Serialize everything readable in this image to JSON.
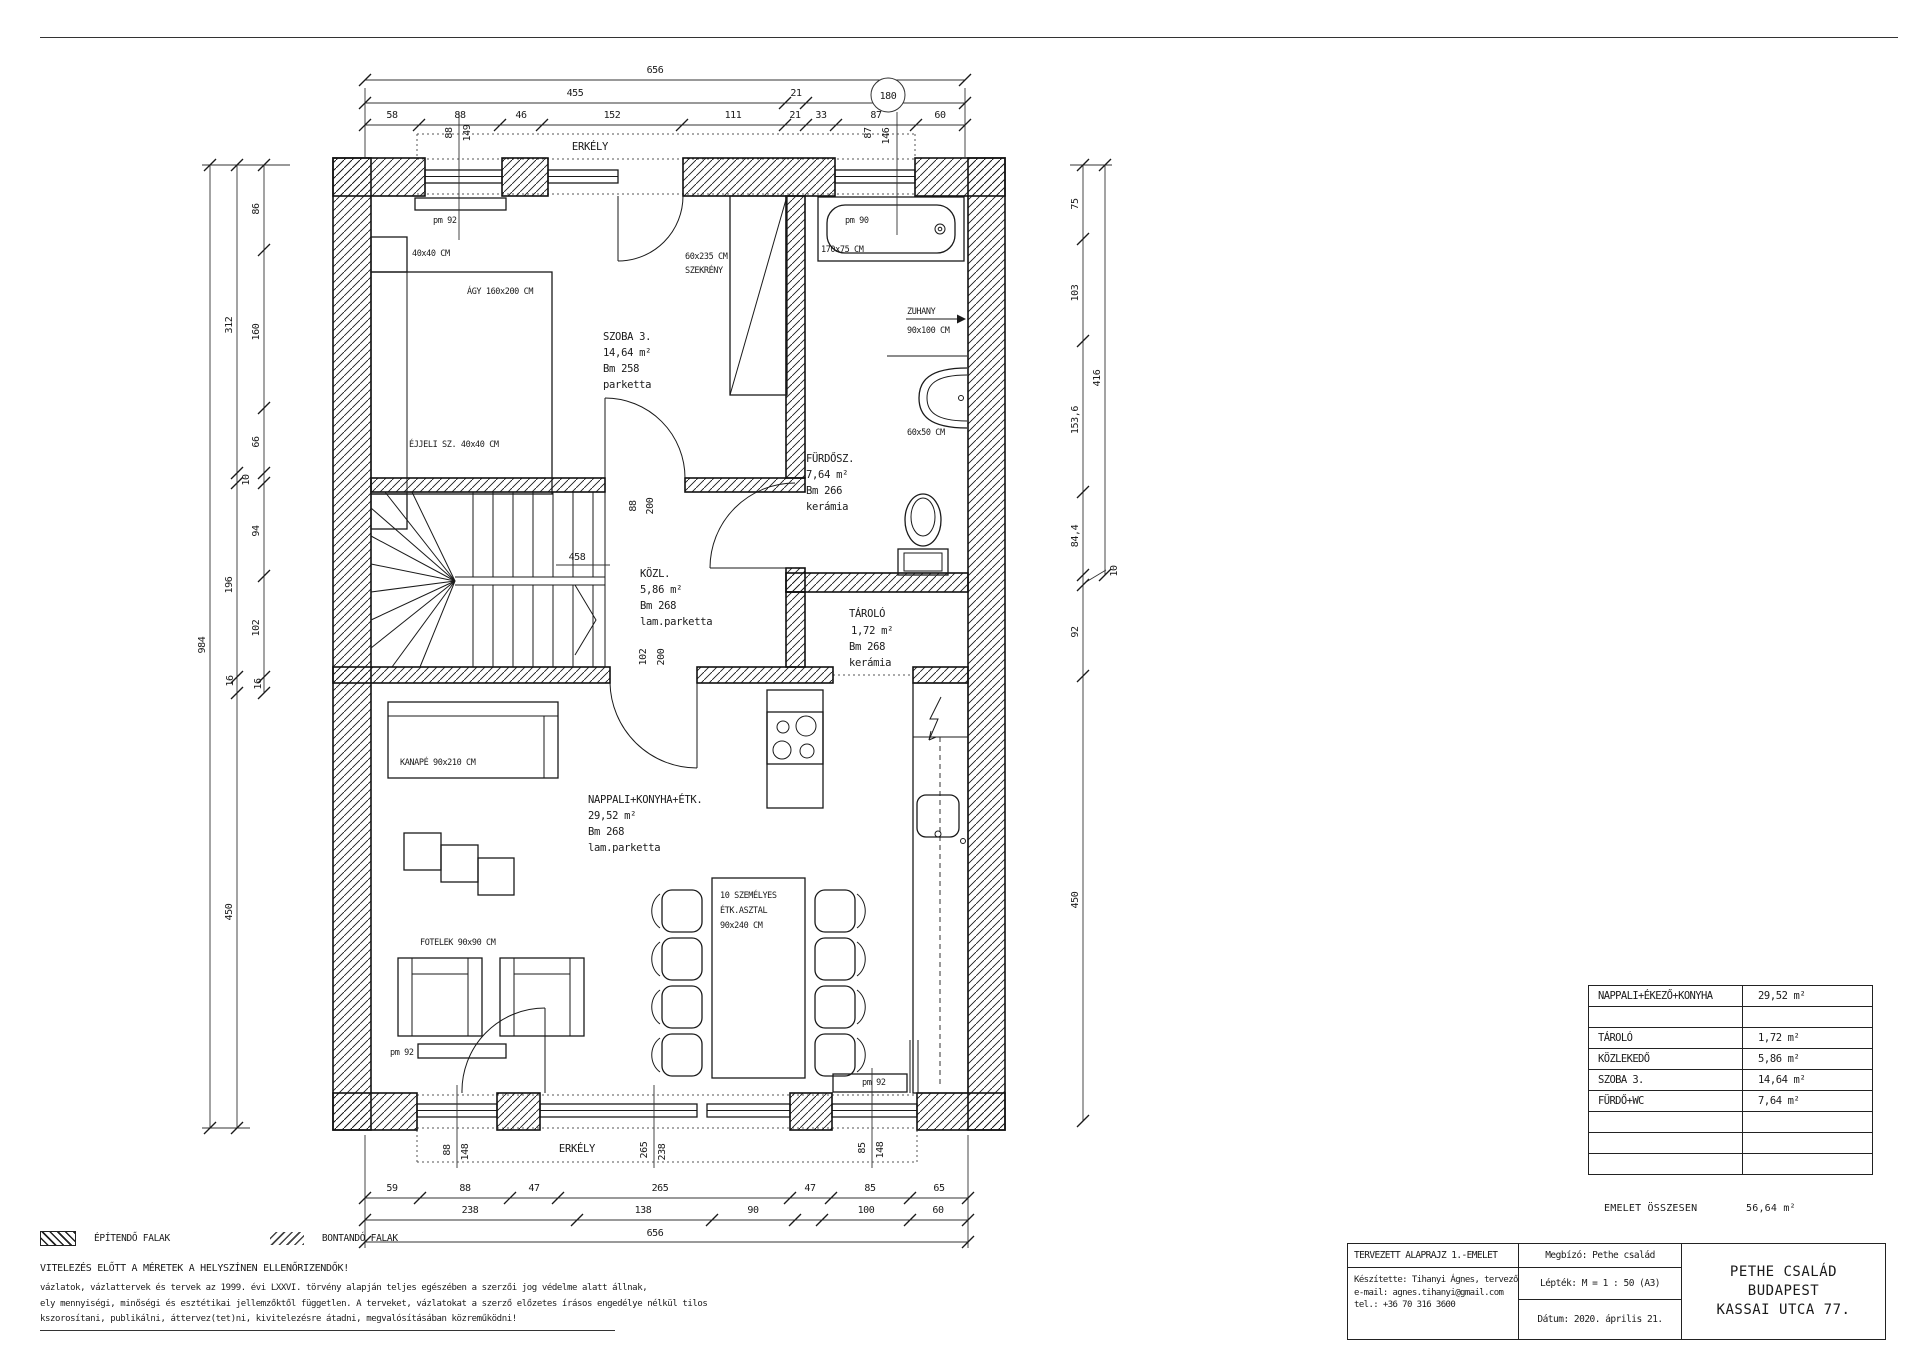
{
  "colors": {
    "paper": "#ffffff",
    "ink": "#1a1a1a"
  },
  "sheet": {
    "legend": {
      "build": "ÉPÍTENDŐ FALAK",
      "demolish": "BONTANDÓ FALAK"
    },
    "disclaimer": {
      "heading": "VITELEZÉS ELŐTT A MÉRETEK A HELYSZÍNEN ELLENŐRIZENDŐK!",
      "line1": "vázlatok, vázlattervek és tervek az 1999. évi LXXVI. törvény alapján teljes egészében a szerzői jog védelme alatt állnak,",
      "line2": "ely mennyiségi, minőségi és esztétikai jellemzőktől független. A terveket, vázlatokat a szerző előzetes írásos engedélye nélkül tilos",
      "line3": "kszorosítani, publikálni, áttervez(tet)ni, kivitelezésre átadni, megvalósításában közreműködni!"
    }
  },
  "plan": {
    "balcony_top": "ERKÉLY",
    "balcony_bottom": "ERKÉLY",
    "rooms": {
      "szoba3": [
        "SZOBA 3.",
        "14,64 m²",
        "Bm 258",
        "parketta"
      ],
      "furdosz": [
        "FÜRDŐSZ.",
        "7,64 m²",
        "Bm 266",
        "kerámia"
      ],
      "kozl": [
        "KÖZL.",
        "5,86 m²",
        "Bm 268",
        "lam.parketta"
      ],
      "tarolo": [
        "TÁROLÓ",
        "1,72 m²",
        "Bm 268",
        "kerámia"
      ],
      "nappali": [
        "NAPPALI+KONYHA+ÉTK.",
        "29,52 m²",
        "Bm 268",
        "lam.parketta"
      ]
    },
    "furniture": {
      "bed": "ÁGY 160x200 CM",
      "nightstand_top": "40x40 CM",
      "nightstand_bottom": "ÉJJELI SZ. 40x40 CM",
      "wardrobe": [
        "60x235 CM",
        "SZEKRÉNY"
      ],
      "tub": "170x75 CM",
      "shower": [
        "ZUHANY",
        "90x100 CM"
      ],
      "basin": "60x50 CM",
      "sofa": "KANAPÉ 90x210 CM",
      "armchairs": "FOTELEK 90x90 CM",
      "dining_table": [
        "10 SZEMÉLYES",
        "ÉTK.ASZTAL",
        "90x240 CM"
      ]
    },
    "windows": {
      "top_left": "pm 92",
      "bath": "pm 90",
      "bottom_left": "pm 92",
      "bottom_right": "pm 92"
    },
    "stair_note": "458",
    "door_dims": {
      "d1": [
        "88",
        "200"
      ],
      "d2": [
        "102",
        "200"
      ]
    }
  },
  "dims": {
    "top": {
      "total": "656",
      "seg455": "455",
      "seg21": "21",
      "bubble": "180",
      "row": [
        "58",
        "88",
        "46",
        "152",
        "111",
        "21",
        "33",
        "87",
        "60"
      ],
      "vleft": [
        "88",
        "149"
      ],
      "vright": [
        "87",
        "146"
      ]
    },
    "left": {
      "total": "984",
      "mid": [
        "312",
        "196",
        "16",
        "450"
      ],
      "inner": [
        "86",
        "160",
        "66",
        "10",
        "94",
        "102",
        "16"
      ]
    },
    "right": {
      "inner": [
        "75",
        "103",
        "153,6",
        "84,4"
      ],
      "outer": "416",
      "off": "10",
      "lower": [
        "92",
        "450"
      ]
    },
    "bottom": {
      "row1": [
        "59",
        "88",
        "47",
        "265",
        "47",
        "85",
        "65"
      ],
      "row2": [
        "238",
        "138",
        "90",
        "100",
        "60"
      ],
      "total": "656",
      "v1": [
        "88",
        "148"
      ],
      "v2": [
        "265",
        "238"
      ],
      "v3": [
        "85",
        "148"
      ]
    }
  },
  "area_table": {
    "rows": [
      {
        "name": "NAPPALI+ÉKEZŐ+KONYHA",
        "area": "29,52 m²"
      },
      {
        "name": "",
        "area": ""
      },
      {
        "name": "TÁROLÓ",
        "area": "1,72 m²"
      },
      {
        "name": "KÖZLEKEDŐ",
        "area": "5,86 m²"
      },
      {
        "name": "SZOBA 3.",
        "area": "14,64 m²"
      },
      {
        "name": "FÜRDŐ+WC",
        "area": "7,64 m²"
      },
      {
        "name": "",
        "area": ""
      },
      {
        "name": "",
        "area": ""
      },
      {
        "name": "",
        "area": ""
      }
    ],
    "total_label": "EMELET ÖSSZESEN",
    "total_value": "56,64 m²"
  },
  "title_block": {
    "drawing_title": "TERVEZETT ALAPRAJZ 1.-EMELET",
    "made_by": [
      "Készítette: Tihanyi Ágnes, tervező",
      "e-mail: agnes.tihanyi@gmail.com",
      "tel.: +36 70 316 3600"
    ],
    "client": "Megbízó: Pethe család",
    "scale": "Lépték: M = 1 : 50 (A3)",
    "date": "Dátum: 2020. április 21.",
    "project": [
      "PETHE CSALÁD",
      "BUDAPEST",
      "KASSAI UTCA 77."
    ]
  }
}
